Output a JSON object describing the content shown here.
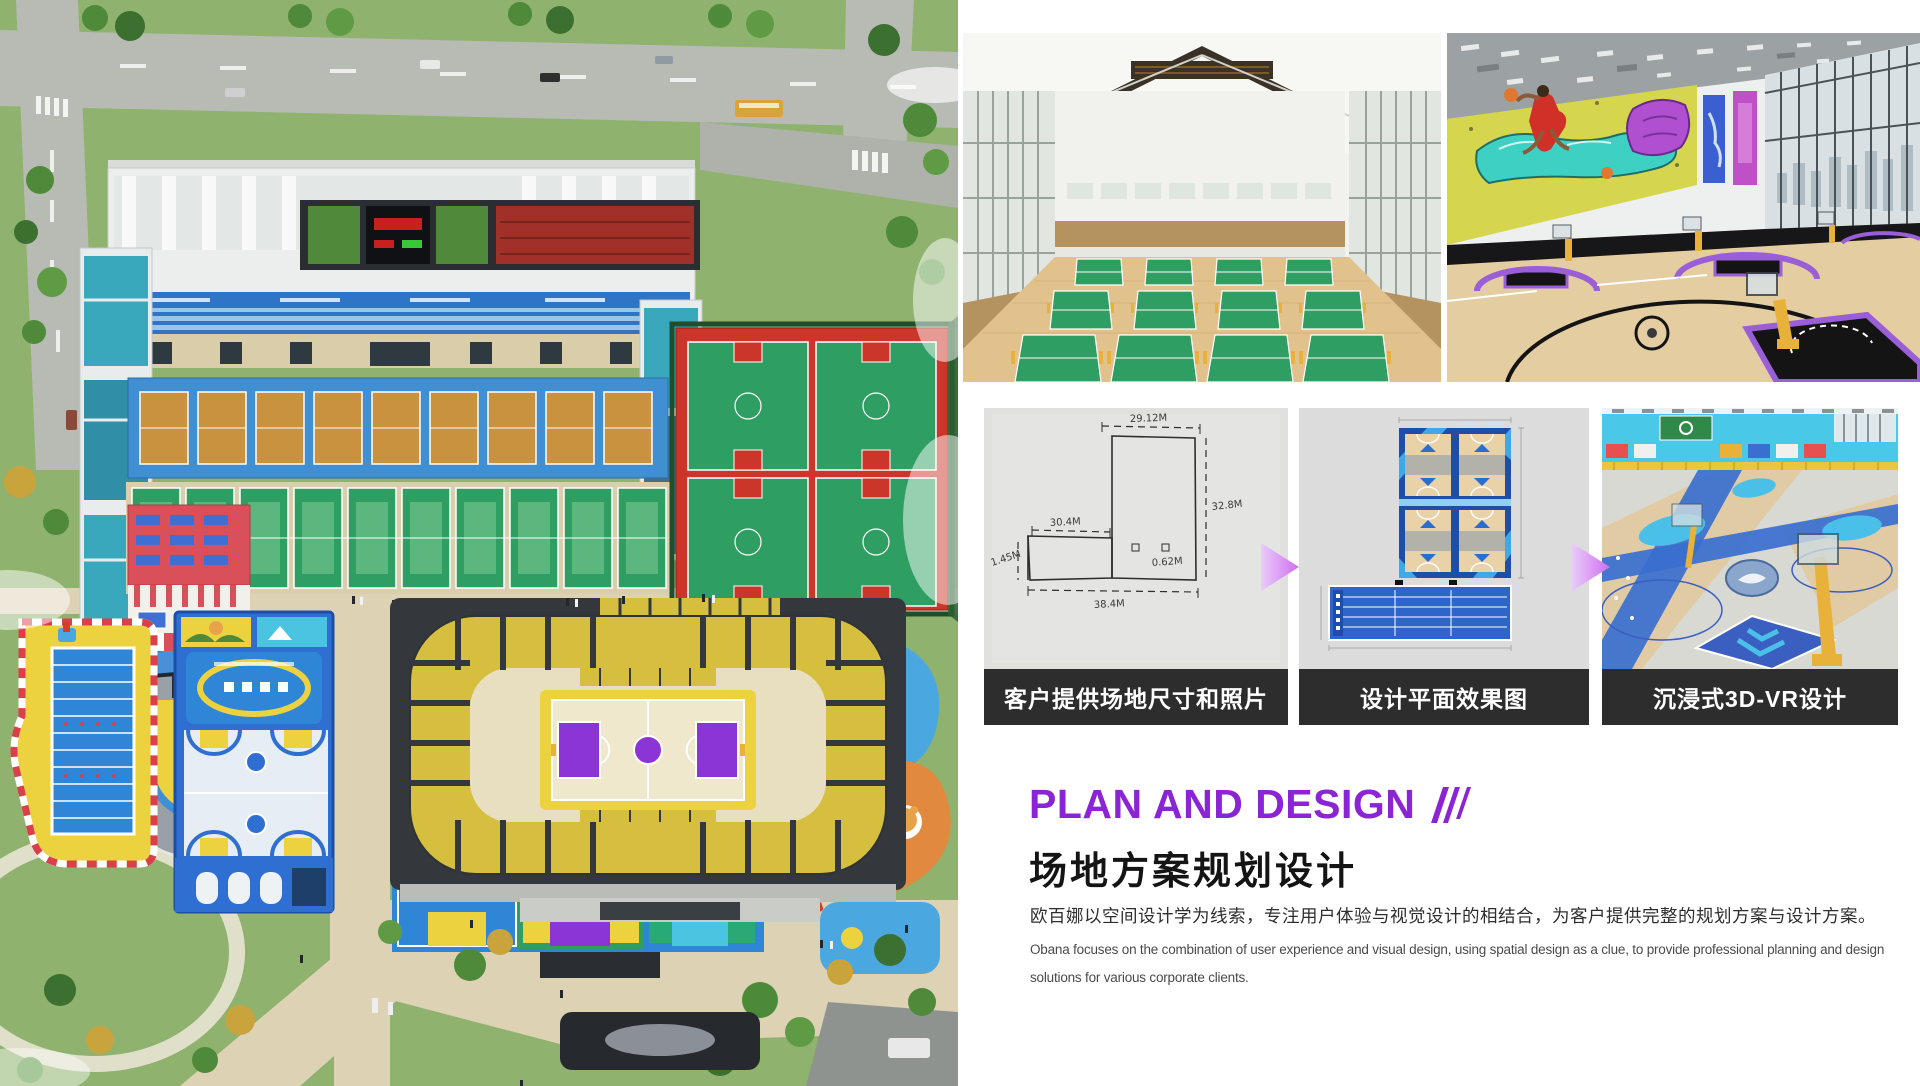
{
  "section": {
    "title_en": "PLAN AND DESIGN",
    "title_zh": "场地方案规划设计",
    "desc_zh": "欧百娜以空间设计学为线索，专注用户体验与视觉设计的相结合，为客户提供完整的规划方案与设计方案。",
    "desc_en_line1": "Obana focuses on the combination of user experience and visual design, using spatial design as a clue, to provide professional planning and design",
    "desc_en_line2": "solutions for various corporate clients."
  },
  "process_steps": [
    {
      "caption": "客户提供场地尺寸和照片",
      "sketch_labels": {
        "top": "29.12M",
        "right": "32.8M",
        "mid": "30.4M",
        "left": "1.45M",
        "inner": "0.62M",
        "bottom": "38.4M"
      }
    },
    {
      "caption": "设计平面效果图"
    },
    {
      "caption": "沉浸式3D-VR设计"
    }
  ],
  "images": {
    "aerial": "sports-park-aerial-render",
    "badminton": "indoor-badminton-hall-render",
    "basketball": "indoor-basketball-hall-graffiti-render",
    "sketch": "hand-drawn-site-dimension-sketch",
    "plan": "2d-floor-plan-render",
    "vr": "immersive-3d-vr-court-render"
  },
  "colors": {
    "accent_purple": "#8a24d4",
    "caption_bar_bg": "#2d2d2d",
    "caption_text": "#ffffff",
    "arrow_gradient_start": "#e9ccf8",
    "arrow_gradient_end": "#d06ef2"
  }
}
